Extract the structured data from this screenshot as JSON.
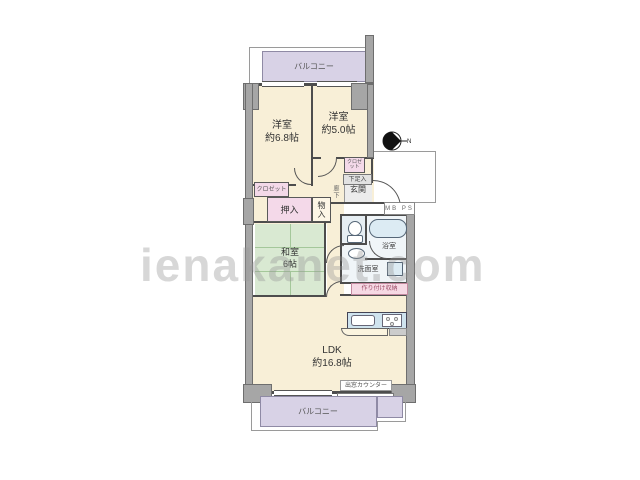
{
  "watermark": {
    "text": "ienakanet.com"
  },
  "compass": {
    "north_label": "N"
  },
  "rooms": {
    "balcony_top": {
      "label": "バルコニー"
    },
    "bedroom_west": {
      "name": "洋室",
      "size": "約6.8帖"
    },
    "bedroom_east": {
      "name": "洋室",
      "size": "約5.0帖"
    },
    "japanese_room": {
      "name": "和室",
      "size": "6帖"
    },
    "ldk": {
      "name": "LDK",
      "size": "約16.8帖"
    },
    "entrance": {
      "label": "玄関"
    },
    "hallway": {
      "label": "廊下"
    },
    "bathroom": {
      "label": "浴室"
    },
    "washroom": {
      "label": "洗面室"
    },
    "balcony_bottom": {
      "label": "バルコニー"
    }
  },
  "storage": {
    "closet_west": {
      "label": "クロゼット"
    },
    "closet_east": {
      "label": "クロゼット"
    },
    "futon_closet": {
      "label": "押入"
    },
    "storage_closet": {
      "label": "物入"
    },
    "shoe_cabinet": {
      "label": "下足入"
    },
    "built_in_storage": {
      "label": "作り付け収納"
    }
  },
  "annotations": {
    "meter_box": "MB PS",
    "bay_window_counter": "出窓カウンター"
  },
  "colors": {
    "room_cream": "#f8efd7",
    "tatami_green": "#d9e9d2",
    "balcony_purple": "#d8d2e6",
    "closet_pink": "#f4d9e9",
    "fixture_blue": "#cfe3ee",
    "wall_gray": "#a6a6a6",
    "line_dark": "#4d4d4d"
  }
}
